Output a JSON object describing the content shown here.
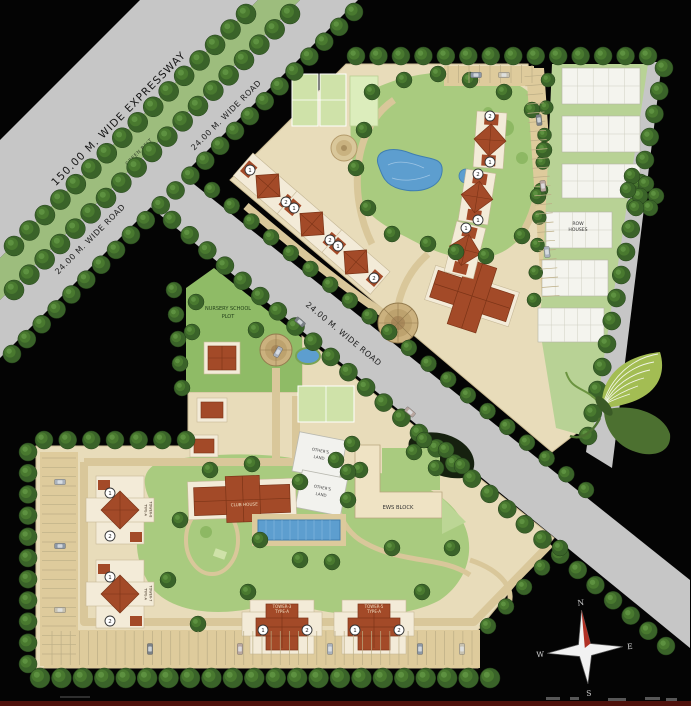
{
  "title": "Residential township master site plan",
  "roads": {
    "expressway_label": "150.00 M. WIDE EXPRESSWAY",
    "green_belt_label": "GREEN BELT",
    "wide_road_label": "24.00 M. WIDE ROAD"
  },
  "areas": {
    "nursery_line1": "NURSERY SCHOOL",
    "nursery_line2": "PLOT",
    "row_houses_line1": "ROW",
    "row_houses_line2": "HOUSES",
    "others_land_line1": "OTHER'S",
    "others_land_line2": "LAND",
    "ews_block_label": "EWS BLOCK",
    "club_house_label": "CLUB HOUSE"
  },
  "towers": {
    "tower3_line1": "TOWER-3",
    "tower3_line2": "TYPE-A",
    "tower5_line1": "TOWER-5",
    "tower5_line2": "TYPE-A",
    "tower7_line1": "TOWER-7",
    "tower7_line2": "TYPE-A",
    "tower8_line1": "TOWER-8",
    "tower8_line2": "TYPE-A",
    "badge_1": "1",
    "badge_2": "2"
  },
  "compass": {
    "north": "N",
    "east": "E",
    "south": "S",
    "west": "W"
  },
  "colors": {
    "background": "#000000",
    "road": "#c6c6c6",
    "green_belt": "#9dbd7d",
    "parcel": "#e8dcba",
    "lawn": "#a9cb7f",
    "water": "#5d9ecf",
    "roof": "#a34a28",
    "tree": "#3a6329",
    "butterfly_light": "#a3bd53",
    "butterfly_dark": "#4c7030",
    "bottom_bar": "#4f120c"
  }
}
